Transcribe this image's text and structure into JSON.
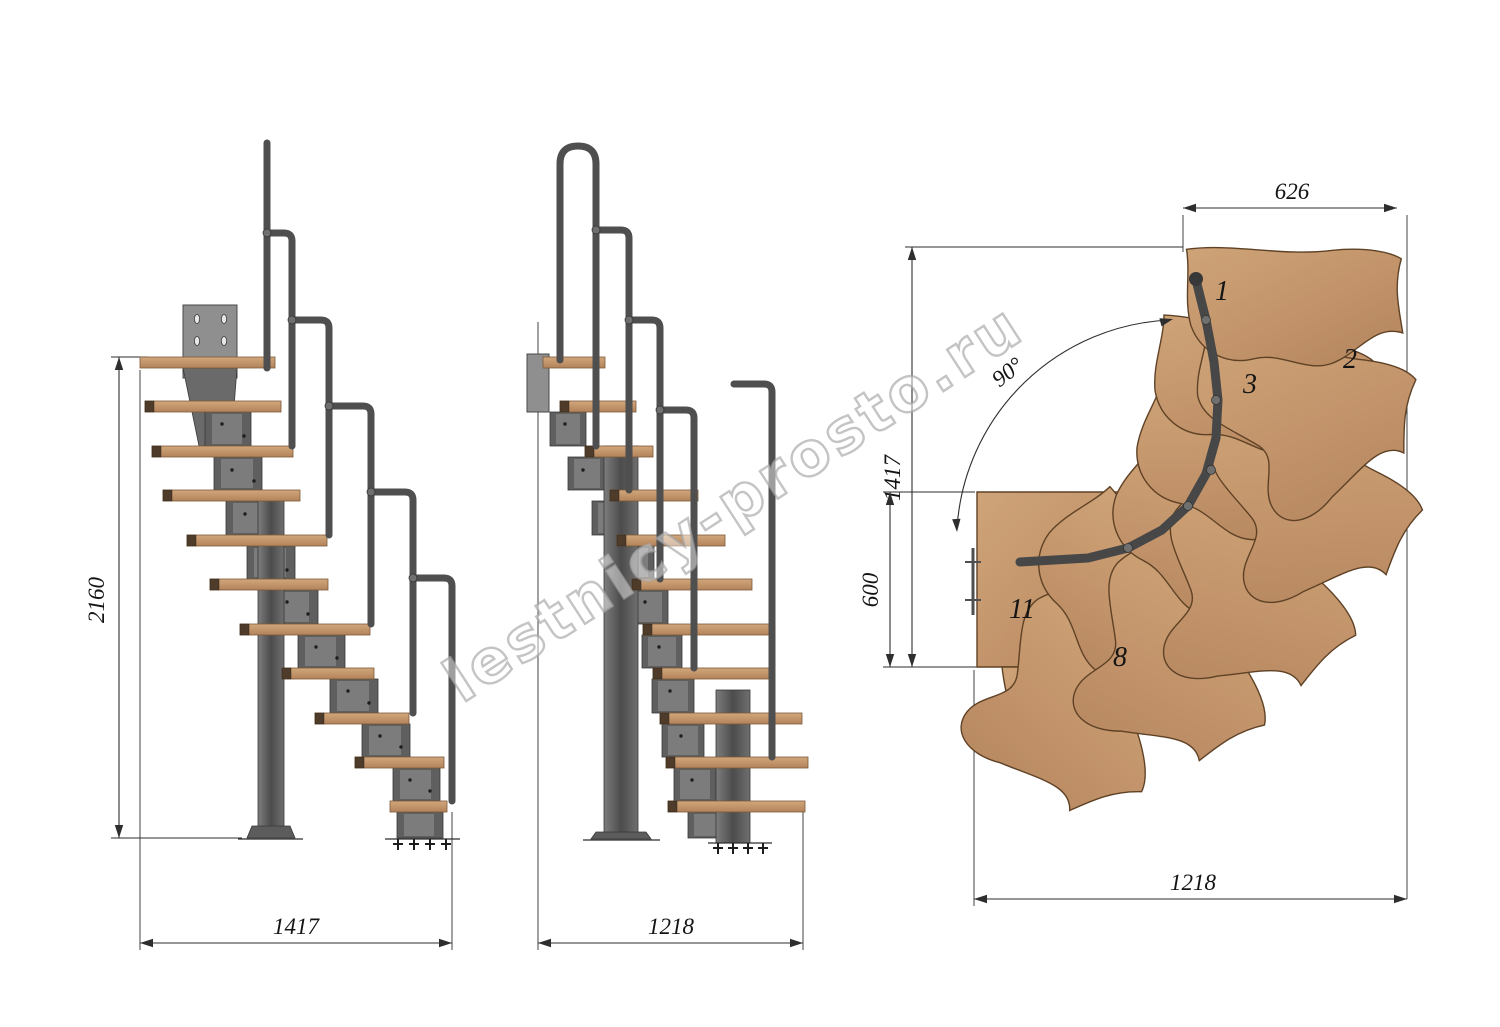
{
  "watermark": {
    "text": "lestnicy-prosto.ru"
  },
  "views": {
    "side": {
      "height_dim": "2160",
      "width_dim": "1417"
    },
    "front": {
      "width_dim": "1218"
    },
    "plan": {
      "top_dim": "626",
      "left_dim": "1417",
      "landing_dim": "600",
      "bottom_dim": "1218",
      "angle_dim": "90°",
      "tread_numbers": [
        "1",
        "2",
        "3",
        "8",
        "11"
      ]
    }
  },
  "colors": {
    "background": "#ffffff",
    "wood": "#c69a72",
    "wood_edge": "#6e4f33",
    "metal": "#5a5a5a",
    "metal_dark": "#3e3e3e",
    "dimension_line": "#2e2e2e",
    "watermark_gray": "#a5a5a5"
  }
}
